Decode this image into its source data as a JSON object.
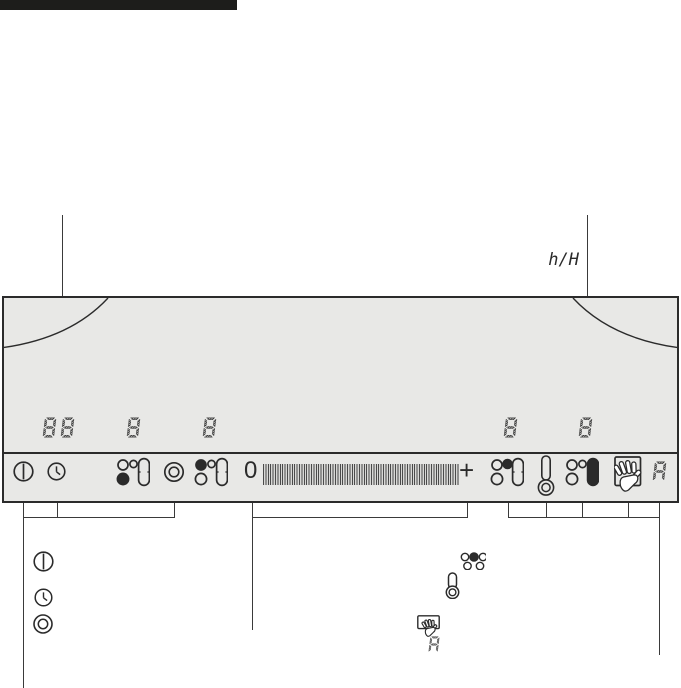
{
  "colors": {
    "ink": "#2b2b2b",
    "panel_bg": "#e8e8e6"
  },
  "callout": {
    "timer_unit_label": "h/H"
  },
  "panel": {
    "displays": {
      "timer": "88",
      "zone_left_front": "8",
      "zone_left_back": "8",
      "zone_right_back": "8",
      "timer_single": "8"
    },
    "strip": {
      "slider": {
        "min_label": "0",
        "plus_label": "+"
      },
      "auto_indicator": "A",
      "icons": [
        "power-icon",
        "timer-clock-icon",
        "zone-select-front-left-icon",
        "twinbooster-icon",
        "zone-select-back-left-icon",
        "power-level-slider",
        "zone-select-back-right-icon",
        "residual-heat-thermometer-icon",
        "zone-select-oval-icon",
        "lock-hand-icon",
        "auto-heatup-indicator"
      ]
    }
  },
  "legend": {
    "auto_indicator": "A",
    "icons": [
      "power-icon",
      "timer-clock-icon",
      "twinbooster-icon",
      "zone-layout-icon",
      "thermometer-icon",
      "lock-hand-icon",
      "auto-heatup-indicator"
    ]
  }
}
